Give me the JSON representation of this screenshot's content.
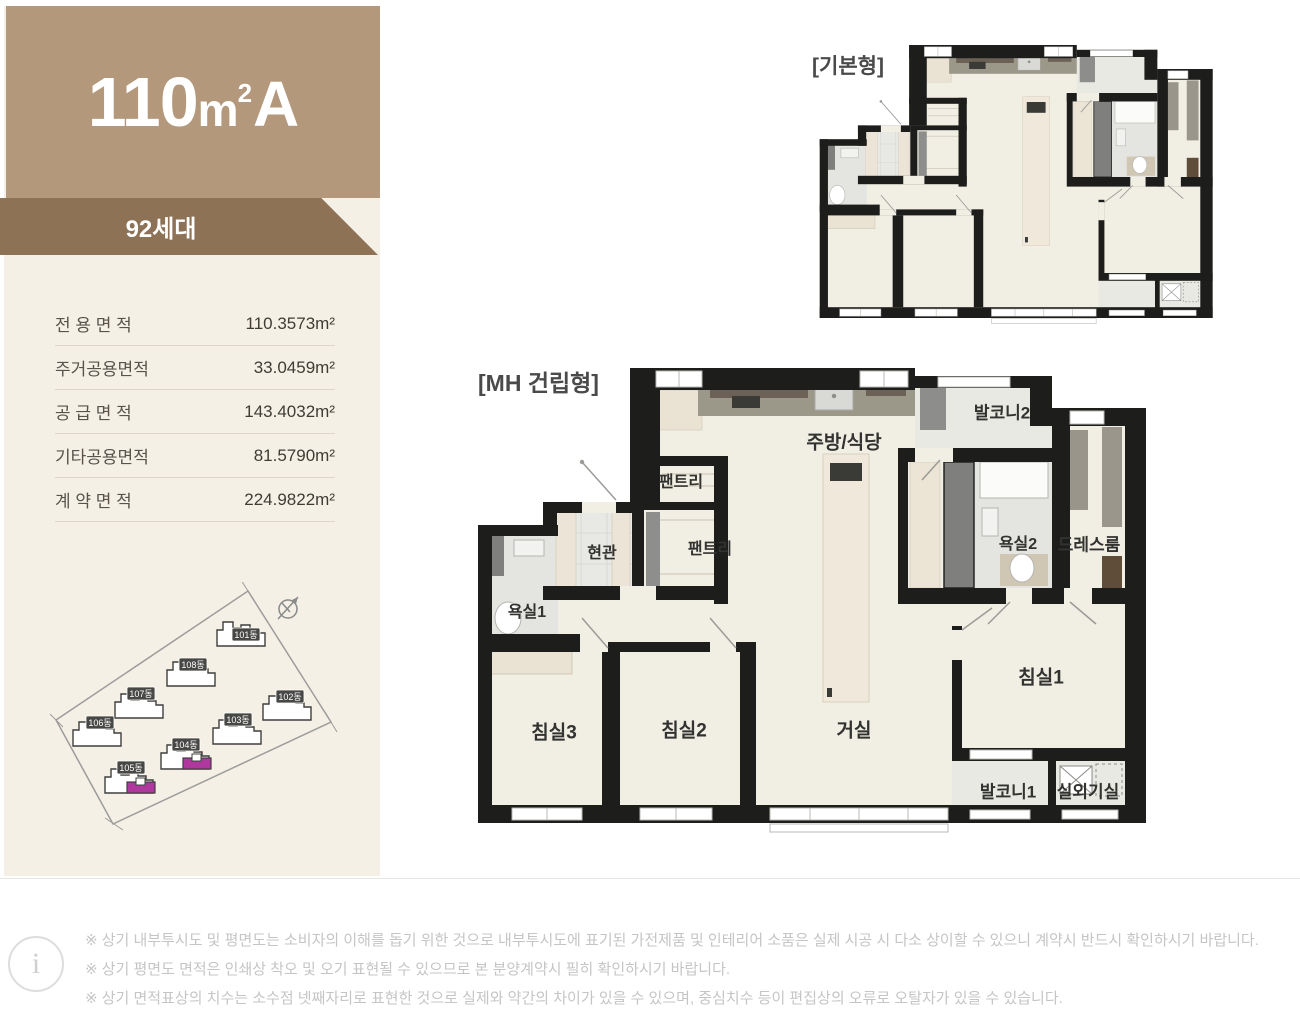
{
  "unit": {
    "area_code": "110",
    "unit_m": "m",
    "unit_sup": "2",
    "type_letter": "A",
    "households": "92세대"
  },
  "area_table": {
    "rows": [
      {
        "label": "전 용 면 적",
        "value": "110.3573m²"
      },
      {
        "label": "주거공용면적",
        "value": "33.0459m²"
      },
      {
        "label": "공 급 면 적",
        "value": "143.4032m²"
      },
      {
        "label": "기타공용면적",
        "value": "81.5790m²"
      },
      {
        "label": "계 약 면 적",
        "value": "224.9822m²"
      }
    ]
  },
  "site_plan": {
    "buildings": [
      {
        "label": "101동"
      },
      {
        "label": "108동"
      },
      {
        "label": "107동"
      },
      {
        "label": "106동"
      },
      {
        "label": "102동"
      },
      {
        "label": "103동"
      },
      {
        "label": "104동"
      },
      {
        "label": "105동"
      }
    ]
  },
  "plans": {
    "basic_caption": "[기본형]",
    "mh_caption": "[MH 건립형]"
  },
  "rooms": [
    {
      "name": "팬트리"
    },
    {
      "name": "팬트리"
    },
    {
      "name": "현관"
    },
    {
      "name": "욕실1"
    },
    {
      "name": "주방/식당"
    },
    {
      "name": "발코니2"
    },
    {
      "name": "욕실2"
    },
    {
      "name": "드레스룸"
    },
    {
      "name": "침실1"
    },
    {
      "name": "침실3"
    },
    {
      "name": "침실2"
    },
    {
      "name": "거실"
    },
    {
      "name": "발코니1"
    },
    {
      "name": "실외기실"
    }
  ],
  "disclaimer": {
    "info_glyph": "i",
    "lines": [
      "※ 상기 내부투시도 및 평면도는 소비자의 이해를 돕기 위한 것으로 내부투시도에 표기된 가전제품 및 인테리어 소품은 실제 시공 시 다소 상이할 수 있으니 계약시 반드시 확인하시기 바랍니다.",
      "※ 상기 평면도 면적은 인쇄상 착오 및 오기 표현될 수 있으므로 본 분양계약시 필히 확인하시기 바랍니다.",
      "※ 상기 면적표상의 치수는 소수점 넷째자리로 표현한 것으로 실제와 약간의 차이가 있을 수 있으며, 중심치수 등이 편집상의 오류로 오탈자가 있을 수 있습니다."
    ]
  },
  "colors": {
    "accent_tan": "#b3987b",
    "band_brown": "#8d7256",
    "panel_cream": "#f5f0e6",
    "highlight_magenta": "#b0379e",
    "wall": "#1d1d1b"
  }
}
